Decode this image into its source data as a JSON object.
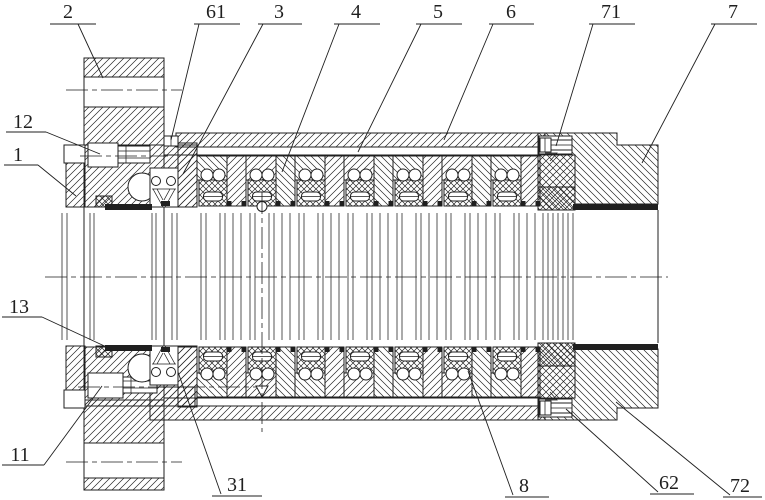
{
  "figure": {
    "background": "#ffffff",
    "line_color": "#1f1f1f",
    "callouts": {
      "c2": "2",
      "c61": "61",
      "c3": "3",
      "c4": "4",
      "c5": "5",
      "c6": "6",
      "c71": "71",
      "c7": "7",
      "c12": "12",
      "c1": "1",
      "c13": "13",
      "c11": "11",
      "c31": "31",
      "c8": "8",
      "c62": "62",
      "c72": "72"
    }
  }
}
